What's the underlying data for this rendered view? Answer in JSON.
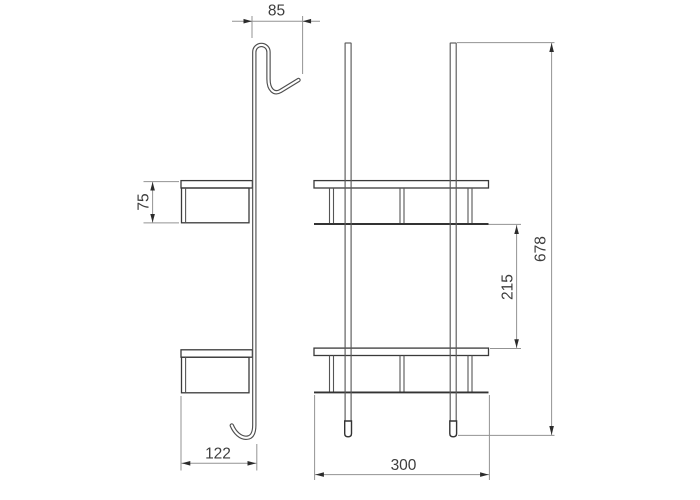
{
  "drawing": {
    "kind": "technical dimension drawing",
    "subject": "two-tier over-door hanging shelf rack",
    "views": {
      "side": "side profile view with over-door hook",
      "front": "front view with two shelves"
    },
    "dimensions": {
      "hook_width": "85",
      "shelf_depth": "75",
      "side_base_width": "122",
      "front_width": "300",
      "shelf_gap": "215",
      "overall_height": "678"
    },
    "colors": {
      "background": "#ffffff",
      "object_line": "#3a3a3a",
      "tube_line": "#4f4f4f",
      "dimension_line": "#939393",
      "arrow": "#2b2b2b",
      "text": "#3d3d3d"
    }
  }
}
